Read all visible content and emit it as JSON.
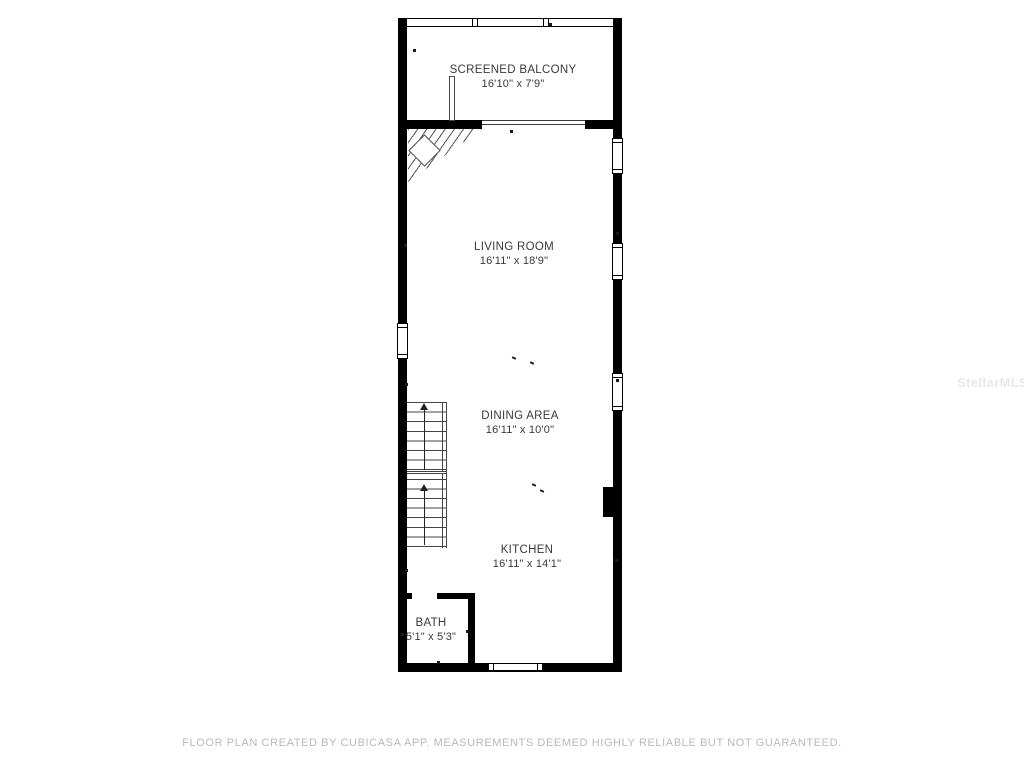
{
  "plan": {
    "rooms": [
      {
        "name": "SCREENED BALCONY",
        "dimensions": "16'10\" x 7'9\""
      },
      {
        "name": "LIVING ROOM",
        "dimensions": "16'11\" x 18'9\""
      },
      {
        "name": "DINING AREA",
        "dimensions": "16'11\" x 10'0\""
      },
      {
        "name": "KITCHEN",
        "dimensions": "16'11\" x 14'1\""
      },
      {
        "name": "BATH",
        "dimensions": "5'1\" x 5'3\""
      }
    ]
  },
  "watermark": {
    "text": "StellarMLS"
  },
  "footer": {
    "text": "FLOOR PLAN CREATED BY CUBICASA APP. MEASUREMENTS DEEMED HIGHLY RELIABLE BUT NOT GUARANTEED."
  },
  "colors": {
    "wall": "#000000",
    "line": "#3c3c3c",
    "label_text": "#3a3a3a",
    "footer_text": "#b9b9b9",
    "watermark_text": "#e9e9e9"
  }
}
